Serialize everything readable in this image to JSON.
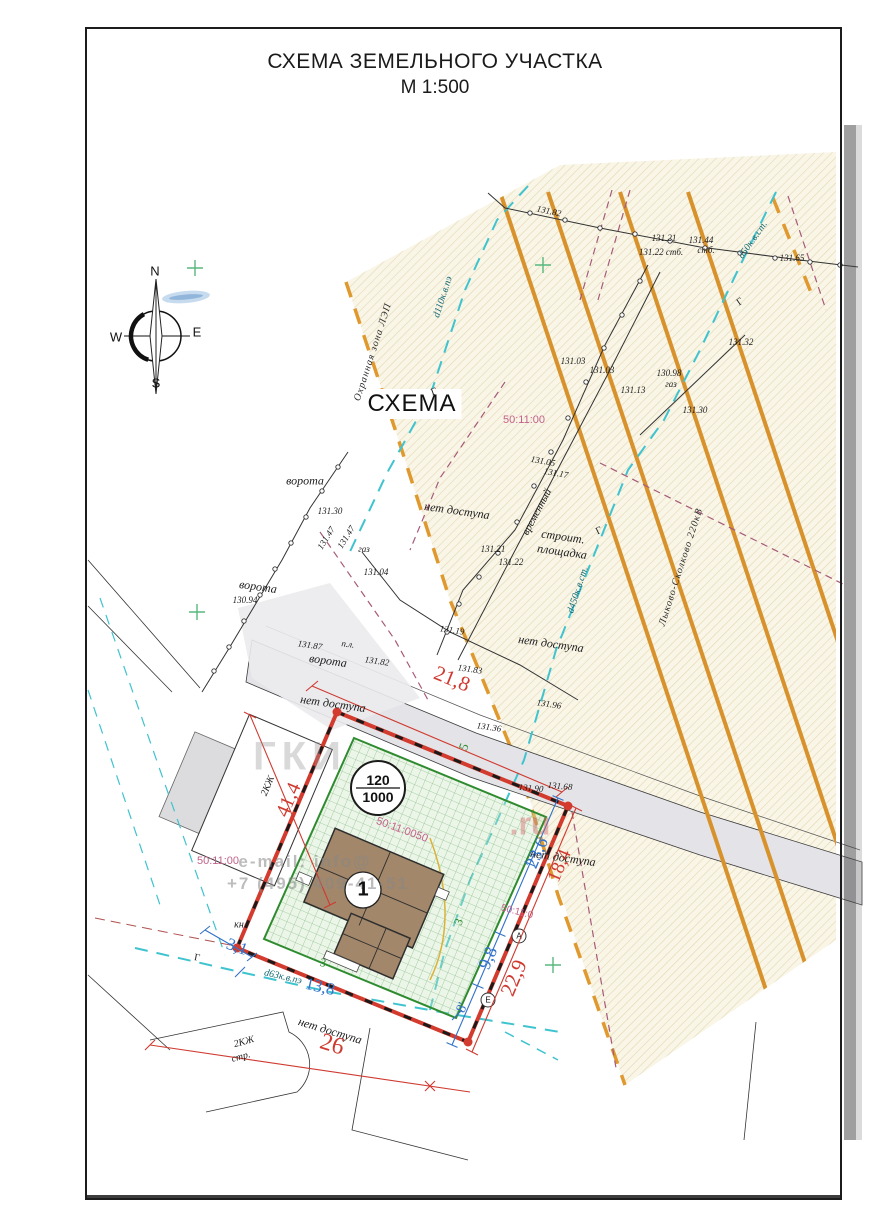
{
  "title": {
    "line1": "СХЕМА ЗЕМЕЛЬНОГО УЧАСТКА",
    "line2": "М 1:500"
  },
  "scheme_label": "СХЕМА",
  "compass": {
    "n": "N",
    "e": "E",
    "s": "S",
    "w": "W"
  },
  "watermark": {
    "big": "ГКИ",
    "ru": ".ru",
    "mail": "e-mail: info@",
    "phone": "+7 (495) 409-41-51"
  },
  "colors": {
    "power_line": "#d8922c",
    "utility_cyan": "#3fc3cf",
    "boundary_red": "#d23b2e",
    "parcel_green": "#2f8b2f",
    "cadastral_pink": "#c2628a",
    "dimension_blue": "#3272c8",
    "dimension_red": "#cf3a30",
    "protection_zone_fill": "#f9f5e7",
    "road_fill": "#e4e4e8"
  },
  "labels": [
    {
      "t": "131.82",
      "x": 549,
      "y": 211,
      "r": 12,
      "c": "topo"
    },
    {
      "t": "131.21",
      "x": 664,
      "y": 238,
      "r": 0,
      "c": "topo"
    },
    {
      "t": "131.44",
      "x": 701,
      "y": 240,
      "r": 0,
      "c": "topo"
    },
    {
      "t": "стб.",
      "x": 706,
      "y": 250,
      "r": 0,
      "c": "topo"
    },
    {
      "t": "131.22 стб.",
      "x": 661,
      "y": 252,
      "r": 0,
      "c": "topo"
    },
    {
      "t": "131.65",
      "x": 792,
      "y": 258,
      "r": 0,
      "c": "topo"
    },
    {
      "t": "131.32",
      "x": 741,
      "y": 342,
      "r": 0,
      "c": "topo"
    },
    {
      "t": "131.03",
      "x": 573,
      "y": 361,
      "r": 0,
      "c": "topo"
    },
    {
      "t": "131.03",
      "x": 602,
      "y": 370,
      "r": 0,
      "c": "topo"
    },
    {
      "t": "131.13",
      "x": 633,
      "y": 390,
      "r": 0,
      "c": "topo"
    },
    {
      "t": "130.98",
      "x": 669,
      "y": 373,
      "r": 0,
      "c": "topo"
    },
    {
      "t": "газ",
      "x": 671,
      "y": 384,
      "r": 0,
      "c": "topo"
    },
    {
      "t": "131.30",
      "x": 695,
      "y": 410,
      "r": 0,
      "c": "topo"
    },
    {
      "t": "131.05",
      "x": 543,
      "y": 461,
      "r": 10,
      "c": "topo"
    },
    {
      "t": "131.17",
      "x": 556,
      "y": 473,
      "r": 10,
      "c": "topo"
    },
    {
      "t": "131.21",
      "x": 493,
      "y": 549,
      "r": 0,
      "c": "topo"
    },
    {
      "t": "131.22",
      "x": 511,
      "y": 562,
      "r": 0,
      "c": "topo"
    },
    {
      "t": "131.30",
      "x": 330,
      "y": 511,
      "r": 0,
      "c": "topo"
    },
    {
      "t": "131.47",
      "x": 326,
      "y": 538,
      "r": -58,
      "c": "topo"
    },
    {
      "t": "131.47",
      "x": 346,
      "y": 537,
      "r": -58,
      "c": "topo"
    },
    {
      "t": "газ",
      "x": 364,
      "y": 549,
      "r": 0,
      "c": "topo"
    },
    {
      "t": "131.04",
      "x": 376,
      "y": 572,
      "r": 0,
      "c": "topo"
    },
    {
      "t": "130.94",
      "x": 245,
      "y": 600,
      "r": 0,
      "c": "topo"
    },
    {
      "t": "131.87",
      "x": 310,
      "y": 645,
      "r": 8,
      "c": "topo"
    },
    {
      "t": "п.л.",
      "x": 348,
      "y": 644,
      "r": 8,
      "c": "topo"
    },
    {
      "t": "131.82",
      "x": 377,
      "y": 661,
      "r": 8,
      "c": "topo"
    },
    {
      "t": "131.19",
      "x": 452,
      "y": 630,
      "r": 8,
      "c": "topo"
    },
    {
      "t": "131.83",
      "x": 470,
      "y": 669,
      "r": 8,
      "c": "topo"
    },
    {
      "t": "131.96",
      "x": 549,
      "y": 704,
      "r": 8,
      "c": "topo"
    },
    {
      "t": "131.36",
      "x": 489,
      "y": 727,
      "r": 8,
      "c": "topo"
    },
    {
      "t": "131.90",
      "x": 531,
      "y": 788,
      "r": 5,
      "c": "topo"
    },
    {
      "t": "131.68",
      "x": 560,
      "y": 786,
      "r": 5,
      "c": "topo"
    },
    {
      "t": "ворота",
      "x": 305,
      "y": 481,
      "r": 0,
      "c": "note",
      "n": "gate-label"
    },
    {
      "t": "ворота",
      "x": 258,
      "y": 587,
      "r": 8,
      "c": "note",
      "n": "gate-label"
    },
    {
      "t": "ворота",
      "x": 328,
      "y": 661,
      "r": 8,
      "c": "note",
      "n": "gate-label"
    },
    {
      "t": "нет доступа",
      "x": 457,
      "y": 511,
      "r": 8,
      "c": "note",
      "n": "no-access-label"
    },
    {
      "t": "нет доступа",
      "x": 551,
      "y": 644,
      "r": 8,
      "c": "note",
      "n": "no-access-label"
    },
    {
      "t": "нет доступа",
      "x": 333,
      "y": 704,
      "r": 8,
      "c": "note",
      "n": "no-access-label"
    },
    {
      "t": "нет доступа",
      "x": 563,
      "y": 858,
      "r": 8,
      "c": "note",
      "n": "no-access-label"
    },
    {
      "t": "нет доступа",
      "x": 330,
      "y": 1031,
      "r": 17,
      "c": "note",
      "n": "no-access-label"
    },
    {
      "t": "строит.",
      "x": 563,
      "y": 537,
      "r": 8,
      "c": "note",
      "n": "construction-site-label"
    },
    {
      "t": "площадка",
      "x": 562,
      "y": 552,
      "r": 8,
      "c": "note",
      "n": "construction-site-label"
    },
    {
      "t": "временный",
      "x": 537,
      "y": 512,
      "r": -62,
      "c": "note",
      "s": 11,
      "n": "temporary-fence-label"
    },
    {
      "t": "кн",
      "x": 239,
      "y": 925,
      "r": 0,
      "c": "topo",
      "s": 10
    },
    {
      "t": "2КЖ",
      "x": 268,
      "y": 786,
      "r": -67,
      "c": "topo",
      "s": 10,
      "n": "building-2kzh-label"
    },
    {
      "t": "2КЖ",
      "x": 244,
      "y": 1042,
      "r": -15,
      "c": "topo",
      "s": 10,
      "n": "building-2kzh-str-label"
    },
    {
      "t": "стр.",
      "x": 241,
      "y": 1057,
      "r": -15,
      "c": "topo",
      "s": 10
    },
    {
      "t": "Охранная зона ЛЭП",
      "x": 373,
      "y": 352,
      "r": -72,
      "c": "zone",
      "n": "protection-zone-label"
    },
    {
      "t": "Лыково-Сколково 220кВ",
      "x": 681,
      "y": 567,
      "r": -72,
      "c": "zone",
      "n": "power-line-label"
    },
    {
      "t": "d110к.в.пэ",
      "x": 443,
      "y": 297,
      "r": -72,
      "c": "pipe",
      "n": "pipe-label"
    },
    {
      "t": "d50к.в.ст.",
      "x": 753,
      "y": 240,
      "r": -55,
      "c": "pipe",
      "n": "pipe-label"
    },
    {
      "t": "d450к.в.ст.",
      "x": 578,
      "y": 590,
      "r": -72,
      "c": "pipe",
      "n": "pipe-label"
    },
    {
      "t": "d63к.в.пэ",
      "x": 283,
      "y": 977,
      "r": 13,
      "c": "pipe",
      "n": "pipe-label"
    },
    {
      "t": "Г",
      "x": 434,
      "y": 392,
      "r": -20,
      "c": "g"
    },
    {
      "t": "Г",
      "x": 599,
      "y": 531,
      "r": -25,
      "c": "g"
    },
    {
      "t": "Г",
      "x": 740,
      "y": 302,
      "r": -35,
      "c": "g"
    },
    {
      "t": "Г",
      "x": 197,
      "y": 958,
      "r": 10,
      "c": "g"
    },
    {
      "t": "21,8",
      "x": 452,
      "y": 679,
      "r": 22,
      "c": "dimr",
      "s": 21,
      "n": "dimension-21-8"
    },
    {
      "t": "41,4",
      "x": 289,
      "y": 800,
      "r": -67,
      "c": "dimr",
      "s": 20,
      "n": "dimension-41-4"
    },
    {
      "t": "22,9",
      "x": 514,
      "y": 978,
      "r": -67,
      "c": "dimr",
      "s": 21,
      "n": "dimension-22-9"
    },
    {
      "t": "18,4",
      "x": 560,
      "y": 866,
      "r": -67,
      "c": "dimr",
      "s": 19,
      "n": "dimension-18-4"
    },
    {
      "t": "26",
      "x": 332,
      "y": 1045,
      "r": 17,
      "c": "dimr",
      "s": 24,
      "n": "dimension-26"
    },
    {
      "t": "23,6",
      "x": 537,
      "y": 853,
      "r": -67,
      "c": "dimb",
      "s": 18,
      "n": "dimension-23-6"
    },
    {
      "t": "9,8",
      "x": 488,
      "y": 958,
      "r": -67,
      "c": "dimb",
      "s": 18,
      "n": "dimension-9-8"
    },
    {
      "t": "8'",
      "x": 463,
      "y": 1008,
      "r": -67,
      "c": "dimb",
      "s": 14,
      "n": "dimension-8"
    },
    {
      "t": "3,1",
      "x": 237,
      "y": 947,
      "r": 20,
      "c": "dimb",
      "s": 17,
      "n": "dimension-3-1"
    },
    {
      "t": "13,8",
      "x": 320,
      "y": 987,
      "r": 13,
      "c": "dimb",
      "s": 17,
      "n": "dimension-13-8"
    },
    {
      "t": "5",
      "x": 464,
      "y": 747,
      "r": -67,
      "c": "dimg",
      "s": 13
    },
    {
      "t": "3",
      "x": 459,
      "y": 922,
      "r": -67,
      "c": "dimg",
      "s": 12
    },
    {
      "t": "3",
      "x": 323,
      "y": 963,
      "r": 13,
      "c": "dimg",
      "s": 12
    },
    {
      "t": "50:11:00",
      "x": 524,
      "y": 420,
      "r": 0,
      "c": "pink",
      "n": "cadastral-quarter"
    },
    {
      "t": "50:11:00",
      "x": 218,
      "y": 861,
      "r": 0,
      "c": "pink",
      "n": "cadastral-quarter"
    },
    {
      "t": "50:11:0050",
      "x": 402,
      "y": 830,
      "r": 20,
      "c": "pink",
      "n": "cadastral-parcel"
    },
    {
      "t": "50:11:0",
      "x": 517,
      "y": 912,
      "r": 14,
      "c": "pink",
      "s": 10,
      "n": "cadastral-quarter"
    },
    {
      "t": "120",
      "x": 378,
      "y": 780,
      "r": 0,
      "c": "circ",
      "n": "ratio-numerator"
    },
    {
      "t": "1000",
      "x": 378,
      "y": 797,
      "r": 0,
      "c": "circ",
      "n": "ratio-denominator"
    },
    {
      "t": "1",
      "x": 363,
      "y": 890,
      "r": 0,
      "c": "circ1",
      "n": "building-number"
    },
    {
      "t": "А",
      "x": 519,
      "y": 936,
      "r": 0,
      "c": "circs",
      "n": "point-a"
    },
    {
      "t": "Е",
      "x": 488,
      "y": 1000,
      "r": 0,
      "c": "circs",
      "n": "point-e"
    }
  ]
}
